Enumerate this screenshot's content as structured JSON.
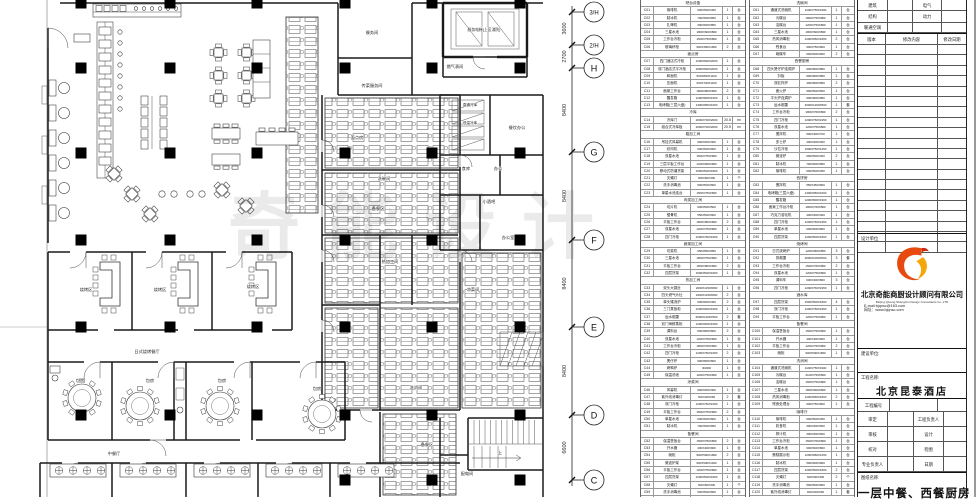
{
  "watermark": "奇能设计",
  "grid": {
    "bubbles": [
      {
        "label": "3/H"
      },
      {
        "label": "2/H"
      },
      {
        "label": "H"
      },
      {
        "label": "G"
      },
      {
        "label": "F"
      },
      {
        "label": "E"
      },
      {
        "label": "D"
      },
      {
        "label": "C"
      }
    ],
    "dims": [
      "3600",
      "2700",
      "8400",
      "8400",
      "8400",
      "8400",
      "6600"
    ]
  },
  "plan": {
    "labels": [
      {
        "t": "餐务间"
      },
      {
        "t": "传菜服务间"
      },
      {
        "t": "服务电梯(上区消防)"
      },
      {
        "t": "燃气表间"
      },
      {
        "t": "直通冷库"
      },
      {
        "t": "低温冷库"
      },
      {
        "t": "餐饮办公"
      },
      {
        "t": "食库"
      },
      {
        "t": "办公"
      },
      {
        "t": "小酒吧"
      },
      {
        "t": "办公室"
      },
      {
        "t": "面点房"
      },
      {
        "t": "洗碗间"
      },
      {
        "t": "备餐区"
      },
      {
        "t": "热加工间"
      },
      {
        "t": "凉菜间"
      },
      {
        "t": "洗消间"
      },
      {
        "t": "配电间"
      },
      {
        "t": "烧烤区"
      },
      {
        "t": "烧烤区"
      },
      {
        "t": "烧烤区"
      },
      {
        "t": "日式烧烤餐厅"
      },
      {
        "t": "包房"
      },
      {
        "t": "包房"
      },
      {
        "t": "包房"
      },
      {
        "t": "包房"
      },
      {
        "t": "中餐厅"
      },
      {
        "t": "上"
      },
      {
        "t": "备餐区"
      }
    ]
  },
  "equipment_tables": [
    {
      "rows": [
        {
          "h": "吧台设备"
        },
        {
          "c": "C01",
          "n": "咖啡机",
          "d": "600X500X450",
          "q": "1",
          "u": "台"
        },
        {
          "c": "C02",
          "n": "制冰机",
          "d": "700X600X850",
          "q": "1",
          "u": "台"
        },
        {
          "c": "C03",
          "n": "扎啤机",
          "d": "300X600X850",
          "q": "1",
          "u": "台"
        },
        {
          "c": "C04",
          "n": "三星水池",
          "d": "1800X600X800",
          "q": "1",
          "u": "台"
        },
        {
          "c": "C05",
          "n": "工作台冷柜",
          "d": "1500X750X800",
          "q": "1",
          "u": "台"
        },
        {
          "c": "C06",
          "n": "玻璃杯柜",
          "d": "900X450X1800",
          "q": "2",
          "u": "台"
        },
        {
          "h": "面点房"
        },
        {
          "c": "C07",
          "n": "四门酒店式冷柜",
          "d": "1200X900X2000",
          "q": "1",
          "u": "台"
        },
        {
          "c": "C08",
          "n": "双门酒店式平冷柜",
          "d": "1800X900X2000",
          "q": "1",
          "u": "台"
        },
        {
          "c": "C09",
          "n": "和面机",
          "d": "500X800X1100",
          "q": "1",
          "u": "台"
        },
        {
          "c": "C10",
          "n": "压面机",
          "d": "600X700X1100",
          "q": "1",
          "u": "台"
        },
        {
          "c": "C11",
          "n": "面案工作台",
          "d": "1800X800X800",
          "q": "2",
          "u": "台"
        },
        {
          "c": "C12",
          "n": "醒发箱",
          "d": "1200X800X1900",
          "q": "1",
          "u": "台"
        },
        {
          "c": "C13",
          "n": "电烤箱(三层六盘)",
          "d": "1300X950X1600",
          "q": "1",
          "u": "台"
        },
        {
          "h": "冷库"
        },
        {
          "c": "C14",
          "n": "冷库门",
          "d": "2000X700X2000",
          "q": "20.5",
          "u": "m²"
        },
        {
          "c": "C15",
          "n": "组合式冷库板",
          "d": "2000X700X2000",
          "q": "20.5",
          "u": "m²"
        },
        {
          "h": "粗加工间"
        },
        {
          "c": "C16",
          "n": "吊挂式风幕机",
          "d": "900X300X300",
          "q": "1",
          "u": "台"
        },
        {
          "c": "C17",
          "n": "绞肉机",
          "d": "600X600X900",
          "q": "1",
          "u": "台"
        },
        {
          "c": "C18",
          "n": "双星水池",
          "d": "1500X750X800",
          "q": "1",
          "u": "台"
        },
        {
          "c": "C19",
          "n": "三层平板工作台",
          "d": "1200X900X800",
          "q": "1",
          "u": "台"
        },
        {
          "c": "C20",
          "n": "移动式防潮货架",
          "d": "1500X500X1800",
          "q": "1",
          "u": "台"
        },
        {
          "c": "C21",
          "n": "灭蝇灯",
          "d": "600X60X300",
          "q": "1",
          "u": "个"
        },
        {
          "c": "C22",
          "n": "洗手消毒池",
          "d": "500X500X800",
          "q": "1",
          "u": "台"
        },
        {
          "c": "C23",
          "n": "单星水池连台",
          "d": "1500X750X800",
          "q": "1",
          "u": "台"
        },
        {
          "h": "肉类加工间"
        },
        {
          "c": "C24",
          "n": "切片机",
          "d": "600X500X500",
          "q": "1",
          "u": "台"
        },
        {
          "c": "C25",
          "n": "锯骨机",
          "d": "550X500X900",
          "q": "1",
          "u": "台"
        },
        {
          "c": "C26",
          "n": "平板工作台",
          "d": "1800X800X800",
          "q": "2",
          "u": "台"
        },
        {
          "c": "C27",
          "n": "双星水池",
          "d": "1200X750X800",
          "q": "1",
          "u": "台"
        },
        {
          "c": "C28",
          "n": "四门冷柜",
          "d": "1200X760X1950",
          "q": "1",
          "u": "台"
        },
        {
          "h": "蔬菜加工间"
        },
        {
          "c": "C29",
          "n": "切菜机",
          "d": "650X550X950",
          "q": "1",
          "u": "台"
        },
        {
          "c": "C30",
          "n": "三星水池",
          "d": "1800X750X800",
          "q": "1",
          "u": "台"
        },
        {
          "c": "C31",
          "n": "平板工作台",
          "d": "1500X800X800",
          "q": "2",
          "u": "台"
        },
        {
          "c": "C32",
          "n": "四层货架",
          "d": "1500X500X1800",
          "q": "1",
          "u": "台"
        },
        {
          "h": "热加工间"
        },
        {
          "c": "C33",
          "n": "双头大锅灶",
          "d": "2000X1150X800",
          "q": "1",
          "u": "台"
        },
        {
          "c": "C34",
          "n": "四头燃气炒灶",
          "d": "2400X1150X800",
          "q": "2",
          "u": "台"
        },
        {
          "c": "C35",
          "n": "单头矮汤炉",
          "d": "600X600X450",
          "q": "2",
          "u": "台"
        },
        {
          "c": "C36",
          "n": "三门蒸饭柜",
          "d": "1200X900X1950",
          "q": "1",
          "u": "台"
        },
        {
          "c": "C37",
          "n": "运水烟罩",
          "d": "6000X1200X500",
          "q": "2",
          "u": "套"
        },
        {
          "c": "C38",
          "n": "双门海鲜蒸柜",
          "d": "1200X900X1950",
          "q": "1",
          "u": "台"
        },
        {
          "c": "C39",
          "n": "调料台",
          "d": "800X800X800",
          "q": "2",
          "u": "台"
        },
        {
          "c": "C40",
          "n": "双星水池",
          "d": "1200X750X800",
          "q": "1",
          "u": "台"
        },
        {
          "c": "C41",
          "n": "工作台冷柜",
          "d": "1800X760X800",
          "q": "1",
          "u": "台"
        },
        {
          "c": "C42",
          "n": "四门冷柜",
          "d": "1200X760X1950",
          "q": "2",
          "u": "台"
        },
        {
          "c": "C43",
          "n": "煲仔炉",
          "d": "900X800X800",
          "q": "1",
          "u": "台"
        },
        {
          "c": "C44",
          "n": "烤鸭炉",
          "d": "Φ1000",
          "q": "1",
          "u": "台"
        },
        {
          "c": "C45",
          "n": "保温汤池",
          "d": "1200X750X800",
          "q": "1",
          "u": "台"
        },
        {
          "h": "凉菜间"
        },
        {
          "c": "C46",
          "n": "风幕机",
          "d": "900X300X300",
          "q": "1",
          "u": "台"
        },
        {
          "c": "C47",
          "n": "紫外线消毒灯",
          "d": "600X200X60",
          "q": "2",
          "u": "套"
        },
        {
          "c": "C48",
          "n": "双门冷柜",
          "d": "1200X760X1950",
          "q": "1",
          "u": "台"
        },
        {
          "c": "C49",
          "n": "平板工作台",
          "d": "1500X750X800",
          "q": "2",
          "u": "台"
        },
        {
          "c": "C50",
          "n": "单星水池",
          "d": "600X600X800",
          "q": "1",
          "u": "台"
        },
        {
          "c": "C51",
          "n": "制冰机",
          "d": "700X600X850",
          "q": "1",
          "u": "台"
        },
        {
          "h": "备餐间"
        },
        {
          "c": "C52",
          "n": "保温售饭台",
          "d": "1500X750X800",
          "q": "2",
          "u": "台"
        },
        {
          "c": "C53",
          "n": "开水器",
          "d": "400X400X900",
          "q": "1",
          "u": "台"
        },
        {
          "c": "C54",
          "n": "碗柜",
          "d": "900X500X1800",
          "q": "2",
          "u": "台"
        },
        {
          "c": "C55",
          "n": "微波炉架",
          "d": "900X500X1400",
          "q": "1",
          "u": "台"
        },
        {
          "c": "C56",
          "n": "平板工作台",
          "d": "1200X750X800",
          "q": "1",
          "u": "台"
        },
        {
          "c": "C57",
          "n": "四层货架",
          "d": "1200X500X1800",
          "q": "1",
          "u": "台"
        },
        {
          "c": "C58",
          "n": "灭蝇灯",
          "d": "600X60X300",
          "q": "1",
          "u": "个"
        },
        {
          "c": "C59",
          "n": "洗手消毒池",
          "d": "500X500X800",
          "q": "1",
          "u": "台"
        },
        {
          "c": "C60",
          "n": "茶水柜",
          "d": "900X500X1800",
          "q": "1",
          "u": "台"
        }
      ]
    },
    {
      "rows": [
        {
          "h": "洗碗间"
        },
        {
          "c": "C61",
          "n": "通道式洗碗机",
          "d": "1100X750X1900",
          "q": "1",
          "u": "台"
        },
        {
          "c": "C62",
          "n": "污碟台",
          "d": "1800X750X800",
          "q": "1",
          "u": "台"
        },
        {
          "c": "C63",
          "n": "洁碟台",
          "d": "1200X750X800",
          "q": "1",
          "u": "台"
        },
        {
          "c": "C64",
          "n": "三星水池",
          "d": "1800X600X800",
          "q": "1",
          "u": "台"
        },
        {
          "c": "C65",
          "n": "热风消毒柜",
          "d": "1200X650X1800",
          "q": "2",
          "u": "台"
        },
        {
          "c": "C66",
          "n": "残食台",
          "d": "900X750X800",
          "q": "1",
          "u": "台"
        },
        {
          "c": "C67",
          "n": "碗碟车",
          "d": "600X600X900",
          "q": "2",
          "u": "台"
        },
        {
          "h": "西餐厨房"
        },
        {
          "c": "C68",
          "n": "四头煲仔炉连焗炉",
          "d": "900X800X850",
          "q": "1",
          "u": "台"
        },
        {
          "c": "C69",
          "n": "扒板",
          "d": "900X800X850",
          "q": "1",
          "u": "台"
        },
        {
          "c": "C70",
          "n": "双缸炸炉",
          "d": "400X800X850",
          "q": "2",
          "u": "台"
        },
        {
          "c": "C71",
          "n": "面火炉",
          "d": "900X500X500",
          "q": "1",
          "u": "台"
        },
        {
          "c": "C72",
          "n": "平头炉连焗炉",
          "d": "900X800X850",
          "q": "1",
          "u": "台"
        },
        {
          "c": "C73",
          "n": "运水烟罩",
          "d": "4000X1200X500",
          "q": "1",
          "u": "套"
        },
        {
          "c": "C74",
          "n": "工作台冷柜",
          "d": "1800X760X800",
          "q": "2",
          "u": "台"
        },
        {
          "c": "C75",
          "n": "四门冷柜",
          "d": "1200X760X1950",
          "q": "1",
          "u": "台"
        },
        {
          "c": "C76",
          "n": "双星水池",
          "d": "1200X750X800",
          "q": "1",
          "u": "台"
        },
        {
          "c": "C77",
          "n": "搅拌机",
          "d": "500X400X700",
          "q": "1",
          "u": "台"
        },
        {
          "c": "C78",
          "n": "多士炉",
          "d": "400X300X300",
          "q": "1",
          "u": "台"
        },
        {
          "c": "C79",
          "n": "沙拉冷柜",
          "d": "1500X750X1250",
          "q": "1",
          "u": "台"
        },
        {
          "c": "C80",
          "n": "微波炉",
          "d": "600X500X400",
          "q": "2",
          "u": "台"
        },
        {
          "c": "C81",
          "n": "制冰机",
          "d": "700X600X850",
          "q": "1",
          "u": "台"
        },
        {
          "c": "C82",
          "n": "咖啡机",
          "d": "600X500X450",
          "q": "1",
          "u": "台"
        },
        {
          "h": "西饼房"
        },
        {
          "c": "C83",
          "n": "搅拌机",
          "d": "550X450X800",
          "q": "1",
          "u": "台"
        },
        {
          "c": "C84",
          "n": "电烤箱(三层六盘)",
          "d": "1300X950X1600",
          "q": "1",
          "u": "台"
        },
        {
          "c": "C85",
          "n": "醒发箱",
          "d": "1200X800X1900",
          "q": "1",
          "u": "台"
        },
        {
          "c": "C86",
          "n": "面案工作台冷柜",
          "d": "1800X760X800",
          "q": "1",
          "u": "台"
        },
        {
          "c": "C87",
          "n": "巧克力溶化机",
          "d": "400X300X300",
          "q": "1",
          "u": "台"
        },
        {
          "c": "C88",
          "n": "四门冷柜",
          "d": "1200X760X1950",
          "q": "1",
          "u": "台"
        },
        {
          "c": "C89",
          "n": "单星水池",
          "d": "600X600X800",
          "q": "1",
          "u": "台"
        },
        {
          "c": "C90",
          "n": "四层货架",
          "d": "1200X500X1800",
          "q": "1",
          "u": "台"
        },
        {
          "h": "烧烤间"
        },
        {
          "c": "C91",
          "n": "日式烧烤炉",
          "d": "1200X800X850",
          "q": "3",
          "u": "台"
        },
        {
          "c": "C92",
          "n": "排烟罩",
          "d": "2000X1000X500",
          "q": "3",
          "u": "套"
        },
        {
          "c": "C93",
          "n": "工作台冷柜",
          "d": "1500X760X800",
          "q": "2",
          "u": "台"
        },
        {
          "c": "C94",
          "n": "双星水池",
          "d": "1200X750X800",
          "q": "1",
          "u": "台"
        },
        {
          "c": "C95",
          "n": "调料车",
          "d": "600X400X800",
          "q": "3",
          "u": "台"
        },
        {
          "c": "C96",
          "n": "四门冷柜",
          "d": "1200X760X1950",
          "q": "1",
          "u": "台"
        },
        {
          "h": "酒水库"
        },
        {
          "c": "C97",
          "n": "四层货架",
          "d": "1500X500X1800",
          "q": "4",
          "u": "台"
        },
        {
          "c": "C98",
          "n": "双门冷柜",
          "d": "1200X760X1950",
          "q": "1",
          "u": "台"
        },
        {
          "c": "C99",
          "n": "平板工作台",
          "d": "1200X750X800",
          "q": "1",
          "u": "台"
        },
        {
          "h": "备餐间"
        },
        {
          "c": "C100",
          "n": "保温售饭台",
          "d": "1500X750X800",
          "q": "1",
          "u": "台"
        },
        {
          "c": "C101",
          "n": "开水器",
          "d": "400X400X900",
          "q": "1",
          "u": "台"
        },
        {
          "c": "C102",
          "n": "平板工作台",
          "d": "1200X750X800",
          "q": "2",
          "u": "台"
        },
        {
          "c": "C103",
          "n": "碗柜",
          "d": "900X500X1800",
          "q": "1",
          "u": "台"
        },
        {
          "h": "洗消间"
        },
        {
          "c": "C104",
          "n": "通道式洗碗机",
          "d": "1100X750X1900",
          "q": "1",
          "u": "台"
        },
        {
          "c": "C105",
          "n": "污碟台",
          "d": "2100X750X800",
          "q": "1",
          "u": "台"
        },
        {
          "c": "C106",
          "n": "洁碟台",
          "d": "1500X750X800",
          "q": "1",
          "u": "台"
        },
        {
          "c": "C107",
          "n": "三星水池",
          "d": "1800X600X800",
          "q": "1",
          "u": "台"
        },
        {
          "c": "C108",
          "n": "热风消毒柜",
          "d": "1200X650X1800",
          "q": "2",
          "u": "台"
        },
        {
          "c": "C109",
          "n": "残食处理台",
          "d": "900X750X800",
          "q": "1",
          "u": "台"
        },
        {
          "h": "咖啡厅"
        },
        {
          "c": "C110",
          "n": "咖啡机",
          "d": "600X500X450",
          "q": "1",
          "u": "台"
        },
        {
          "c": "C111",
          "n": "奶昔机",
          "d": "300X300X500",
          "q": "1",
          "u": "台"
        },
        {
          "c": "C112",
          "n": "榨汁机",
          "d": "300X300X500",
          "q": "1",
          "u": "台"
        },
        {
          "c": "C113",
          "n": "工作台冷柜",
          "d": "1500X760X800",
          "q": "1",
          "u": "台"
        },
        {
          "c": "C114",
          "n": "单星水池",
          "d": "600X600X800",
          "q": "1",
          "u": "台"
        },
        {
          "c": "C115",
          "n": "蛋糕展示柜",
          "d": "1200X680X1250",
          "q": "1",
          "u": "台"
        },
        {
          "c": "C116",
          "n": "制冰机",
          "d": "500X600X800",
          "q": "1",
          "u": "台"
        },
        {
          "c": "C117",
          "n": "四层货架",
          "d": "1200X500X1800",
          "q": "2",
          "u": "台"
        },
        {
          "c": "C118",
          "n": "灭蝇灯",
          "d": "600X60X300",
          "q": "2",
          "u": "个"
        },
        {
          "c": "C119",
          "n": "洗手消毒池",
          "d": "500X500X800",
          "q": "1",
          "u": "台"
        },
        {
          "c": "C120",
          "n": "紫外线消毒灯",
          "d": "600X200X60",
          "q": "1",
          "u": "套"
        }
      ]
    }
  ],
  "titleblock": {
    "top_rows": [
      [
        "建筑",
        "电气"
      ],
      [
        "结构",
        "动力"
      ],
      [
        "暖通空调",
        ""
      ]
    ],
    "rev_header": [
      "版本",
      "修改内容",
      "修改日期"
    ],
    "rev_empty_rows": 20,
    "design_unit_label": "设计单位",
    "company_cn": "北京奇能商厨设计顾问有限公司",
    "company_en": "Beijing Qineng Shangchu Design Consultants Co.,LTD",
    "email": "E-mail:bjqnsc@163.com",
    "website": "网址：www.bjqnsc.com",
    "client_label": "建设单位:",
    "project_label": "工程名称:",
    "project_name": "北京昆泰酒店",
    "project_no_label": "工程编号",
    "sign_rows": [
      [
        "审定",
        "工程负责人"
      ],
      [
        "审核",
        "设计"
      ],
      [
        "校对",
        "检图"
      ],
      [
        "专业负责人",
        "日期"
      ]
    ],
    "drawing_label": "图纸名称:",
    "drawing_name": "一层中餐、西餐厨房",
    "logo_colors": {
      "orange": "#e8490e",
      "yellow": "#f5a60b",
      "red": "#c9270f"
    }
  }
}
